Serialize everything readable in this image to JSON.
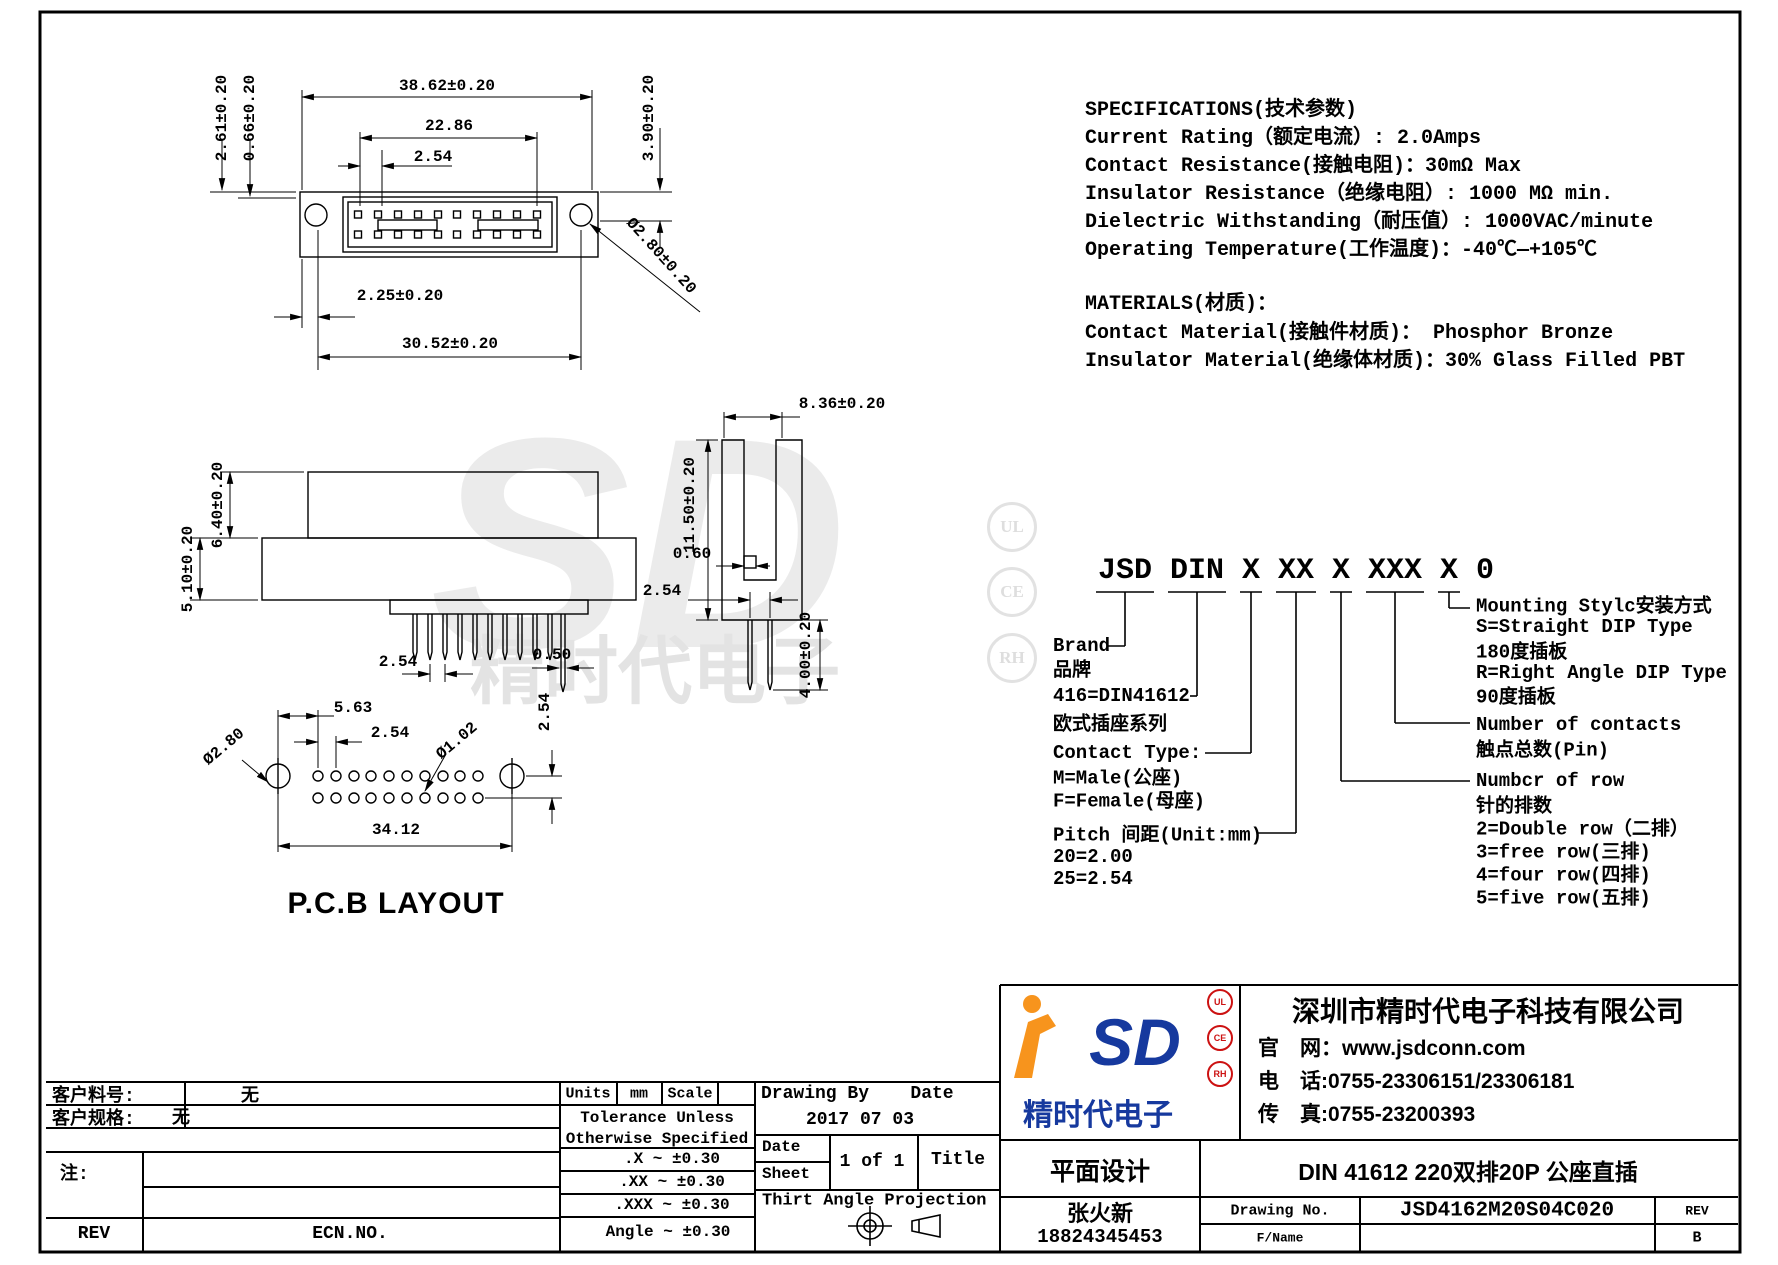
{
  "frame": {
    "bg": "#ffffff",
    "line_color": "#000000",
    "logo_blue": "#16399e",
    "logo_orange": "#f7941d",
    "cert_red": "#cc1111"
  },
  "specs": {
    "title": "SPECIFICATIONS(技术参数)",
    "lines": [
      "Current Rating（额定电流）:   2.0Amps",
      "Contact Resistance(接触电阻)：30mΩ Max",
      "Insulator Resistance（绝缘电阻）: 1000 MΩ min.",
      "Dielectric Withstanding（耐压值）: 1000VAC/minute",
      "Operating Temperature(工作温度)：-40℃—+105℃"
    ],
    "materials_title": "MATERIALS(材质)：",
    "materials_lines": [
      "Contact Material(接触件材质)：   Phosphor Bronze",
      "Insulator Material(绝缘体材质)：30% Glass Filled PBT"
    ]
  },
  "part_code": {
    "code": "JSD DIN X XX X XXX X 0",
    "left_labels": [
      "Brand",
      "品牌",
      "416=DIN41612",
      "欧式插座系列",
      "Contact Type:",
      "M=Male(公座)",
      "F=Female(母座)",
      "Pitch 间距(Unit:mm)",
      "20=2.00",
      "25=2.54"
    ],
    "right_labels": [
      "Mounting Stylc安装方式",
      "S=Straight DIP Type",
      "180度插板",
      "R=Right Angle DIP Type",
      "90度插板",
      "Number of contacts",
      "触点总数(Pin)",
      "Numbcr of row",
      "针的排数",
      "2=Double row（二排）",
      "3=free row(三排)",
      "4=four row(四排)",
      "5=five row(五排)"
    ]
  },
  "dims": {
    "front": [
      "38.62±0.20",
      "22.86",
      "2.54",
      "2.61±0.20",
      "0.66±0.20",
      "3.90±0.20",
      "Ø2.80±0.20",
      "2.25±0.20",
      "30.52±0.20"
    ],
    "side": [
      "5.10±0.20",
      "6.40±0.20",
      "2.54",
      "0.50"
    ],
    "end": [
      "11.50±0.20",
      "8.36±0.20",
      "0.60",
      "2.54",
      "4.00±0.20"
    ],
    "pcb": [
      "5.63",
      "2.54",
      "Ø2.80",
      "Ø1.02",
      "2.54",
      "34.12"
    ]
  },
  "pcb_title": "P.C.B LAYOUT",
  "watermark": {
    "logo": "SD",
    "brand": "精时代电子",
    "certs": [
      "UL",
      "CE",
      "RH"
    ]
  },
  "title_block": {
    "customer_part_label": "客户料号:",
    "customer_part_value": "无",
    "customer_spec_label": "客户规格:",
    "customer_spec_value": "无",
    "note_label": "注:",
    "rev_label": "REV",
    "ecn_label": "ECN.NO.",
    "units_label": "Units",
    "units_value": "mm",
    "scale_label": "Scale",
    "tol_title1": "Tolerance Unless",
    "tol_title2": "Otherwise Specified",
    "tol_rows": [
      ".X  ~  ±0.30",
      ".XX  ~  ±0.30",
      ".XXX  ~  ±0.30",
      "Angle ~  ±0.30"
    ],
    "drawing_by_label": "Drawing By",
    "date_label": "Date",
    "date_value": "2017 07 03",
    "date_cell_label": "Date",
    "sheet_label": "Sheet",
    "sheet_value": "1 of 1",
    "title_label": "Title",
    "projection_label": "Thirt Angle Projection",
    "design_type": "平面设计",
    "product_title": "DIN  41612 220双排20P 公座直插",
    "designer": "张火新",
    "designer_phone": "18824345453",
    "drawing_no_label": "Drawing No.",
    "drawing_no_value": "JSD4162M20S04C020",
    "rev_col_label": "REV",
    "rev_value": "B",
    "fname_label": "F/Name"
  },
  "company": {
    "logo_text": "SD",
    "logo_brand": "精时代电子",
    "certs": [
      "UL",
      "CE",
      "RH"
    ],
    "name": "深圳市精时代电子科技有限公司",
    "website": "官　网：www.jsdconn.com",
    "phone": "电　话:0755-23306151/23306181",
    "fax": "传　真:0755-23200393"
  }
}
